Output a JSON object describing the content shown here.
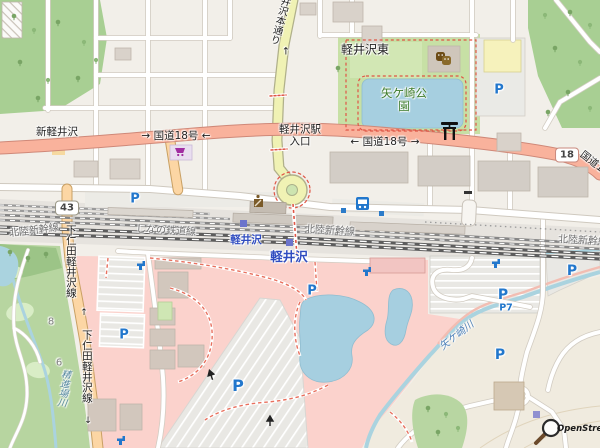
{
  "map": {
    "places": {
      "karuizawa_higashi": "軽井沢東",
      "shin_karuizawa": "新軽井沢"
    },
    "park": {
      "name": "矢ケ崎公園",
      "label_color": "#3e7c2a"
    },
    "roads": {
      "route18_left": "→ 国道18号 ←",
      "route18_right": "← 国道18号 →",
      "route18_edge": "国道18号",
      "station_entrance": "軽井沢駅入口",
      "hondori": "井沢本通り",
      "hondori_arrow": "↑",
      "shimonita": "下仁田軽井沢線",
      "arrow_up": "↑",
      "arrow_down": "↓",
      "shield43": "43",
      "shield18": "18"
    },
    "railways": {
      "hokuriku": "北陸新幹線",
      "shinano": "しなの鉄道線"
    },
    "stations": {
      "karuizawa": "軽井沢"
    },
    "waterways": {
      "yagasaki": "矢ケ崎川",
      "shojinba": "精進場川"
    },
    "parking": {
      "symbol": "P",
      "p7": "P7"
    },
    "golf": {
      "hole8": "8",
      "hole6": "6"
    },
    "attribution": {
      "name": "OpenStreetMap"
    },
    "icons": [
      "supermarket-icon",
      "theatre-icon",
      "torii-icon",
      "bus-station-icon",
      "post-office-icon",
      "drinking-water-icon",
      "oneway-arrow-icon",
      "osm-logo-icon",
      "parking-symbol",
      "station-entrance-marker"
    ],
    "colors": {
      "trunk_road": "#f9b29c",
      "primary_road": "#fcd6a4",
      "secondary_road": "#f0f2b4",
      "water": "#aad3df",
      "park_green": "#c7e0a5",
      "wood_green": "#a8cf93",
      "retail_pink": "#fbd2cc",
      "parking_blue": "#2277cc",
      "station_blue": "#2f4cc0"
    }
  }
}
